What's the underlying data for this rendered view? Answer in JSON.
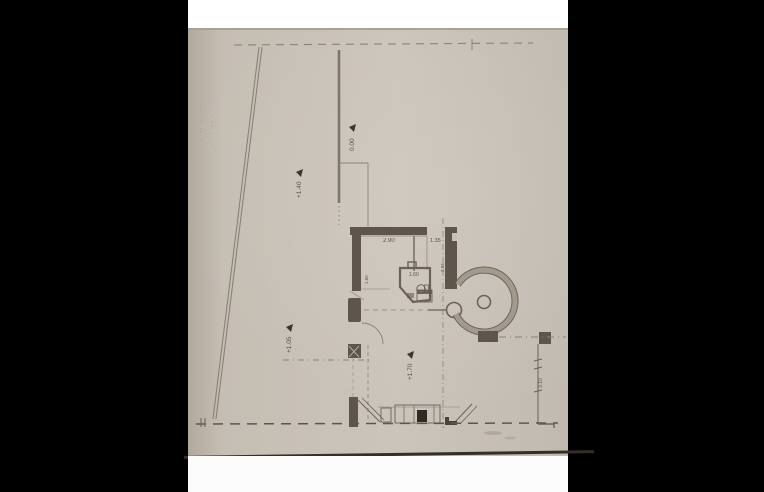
{
  "scene": {
    "description": "Photograph of a scanned architectural floor plan sheet centered on a black background",
    "background_color": "#000000",
    "paper_color": "#c9c2b8",
    "ink_color": "#6b6257",
    "wall_fill_color": "#5f564b",
    "top_strip_color": "#ffffff",
    "bottom_strip_color": "#fcfcfc"
  },
  "labels": {
    "room_dim_1": "2.90",
    "room_dim_2": "1.35",
    "bath_dim": "1.60",
    "wall_dim_left": "1.65",
    "wall_dim_right": "2.04",
    "height_dim": "3.10",
    "level_zero": "0.00",
    "level_terrace": "+1.40",
    "level_court": "+1.05",
    "level_room": "+1.70",
    "margin_note_a": "· ·· · ···",
    "margin_note_b": "·· · ·· ·"
  }
}
